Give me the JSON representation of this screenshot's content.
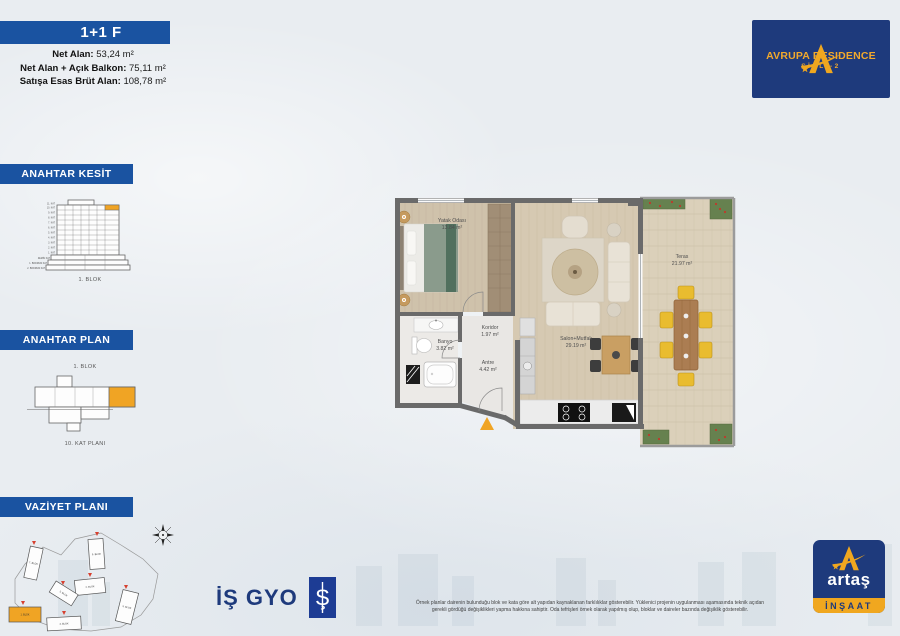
{
  "header": {
    "unit_type": "1+1 F",
    "areas": [
      {
        "label": "Net Alan:",
        "value": "53,24 m²"
      },
      {
        "label": "Net Alan + Açık Balkon:",
        "value": "75,11 m²"
      },
      {
        "label": "Satışa Esas Brüt Alan:",
        "value": "108,78 m²"
      }
    ]
  },
  "brand": {
    "avrupa": {
      "name": "AVRUPA RESIDENCE",
      "sub": "ŞİŞLİ-2"
    },
    "isgyo": {
      "name": "İŞ GYO",
      "symbol": "Ş"
    },
    "artas": {
      "name": "artaş",
      "sub": "İNŞAAT"
    }
  },
  "sidebar": {
    "kesit": {
      "title": "ANAHTAR KESİT",
      "caption": "1. BLOK",
      "floors": [
        "11. KAT",
        "10. KAT",
        "9. KAT",
        "8. KAT",
        "7. KAT",
        "6. KAT",
        "5. KAT",
        "4. KAT",
        "3. KAT",
        "2. KAT",
        "1. KAT",
        "ZEMİN KAT",
        "1. BODRUM KAT",
        "2. BODRUM KAT"
      ]
    },
    "plan": {
      "title": "ANAHTAR PLAN",
      "block": "1. BLOK",
      "caption": "10. KAT PLANI"
    },
    "vaziyet": {
      "title": "VAZİYET PLANI",
      "blocks": [
        "7. BLOK",
        "6. BLOK",
        "2. BLOK",
        "3. BLOK",
        "5. BLOK",
        "1. BLOK",
        "4. BLOK"
      ]
    }
  },
  "floorplan": {
    "rooms": [
      {
        "name": "Yatak Odası",
        "area": "13.84 m²"
      },
      {
        "name": "Koridor",
        "area": "1.97 m²"
      },
      {
        "name": "Banyo",
        "area": "3.82 m²"
      },
      {
        "name": "Antre",
        "area": "4.42 m²"
      },
      {
        "name": "Salon+Mutfak",
        "area": "29.19 m²"
      },
      {
        "name": "Teras",
        "area": "21.97 m²"
      }
    ]
  },
  "footer": {
    "disclaimer1": "Örnek planlar dairenin bulunduğu blok ve kata göre alt yapıdan kaynaklanan farklılıklar gösterebilir. Yüklenici projenin uygulanması aşamasında teknik açıdan",
    "disclaimer2": "gerekli gördüğü değişiklikleri yapma hakkına sahiptir. Oda tefrişleri örnek olarak yapılmış olup, bloklar ve daireler bazında değişiklik gösterebilir."
  },
  "colors": {
    "banner_blue": "#1a53a1",
    "navy": "#1e3a7c",
    "brand_yellow": "#f0a71f",
    "highlight_orange": "#f0a424",
    "wall_gray": "#6a6a6a",
    "red_pin": "#d6402f"
  }
}
